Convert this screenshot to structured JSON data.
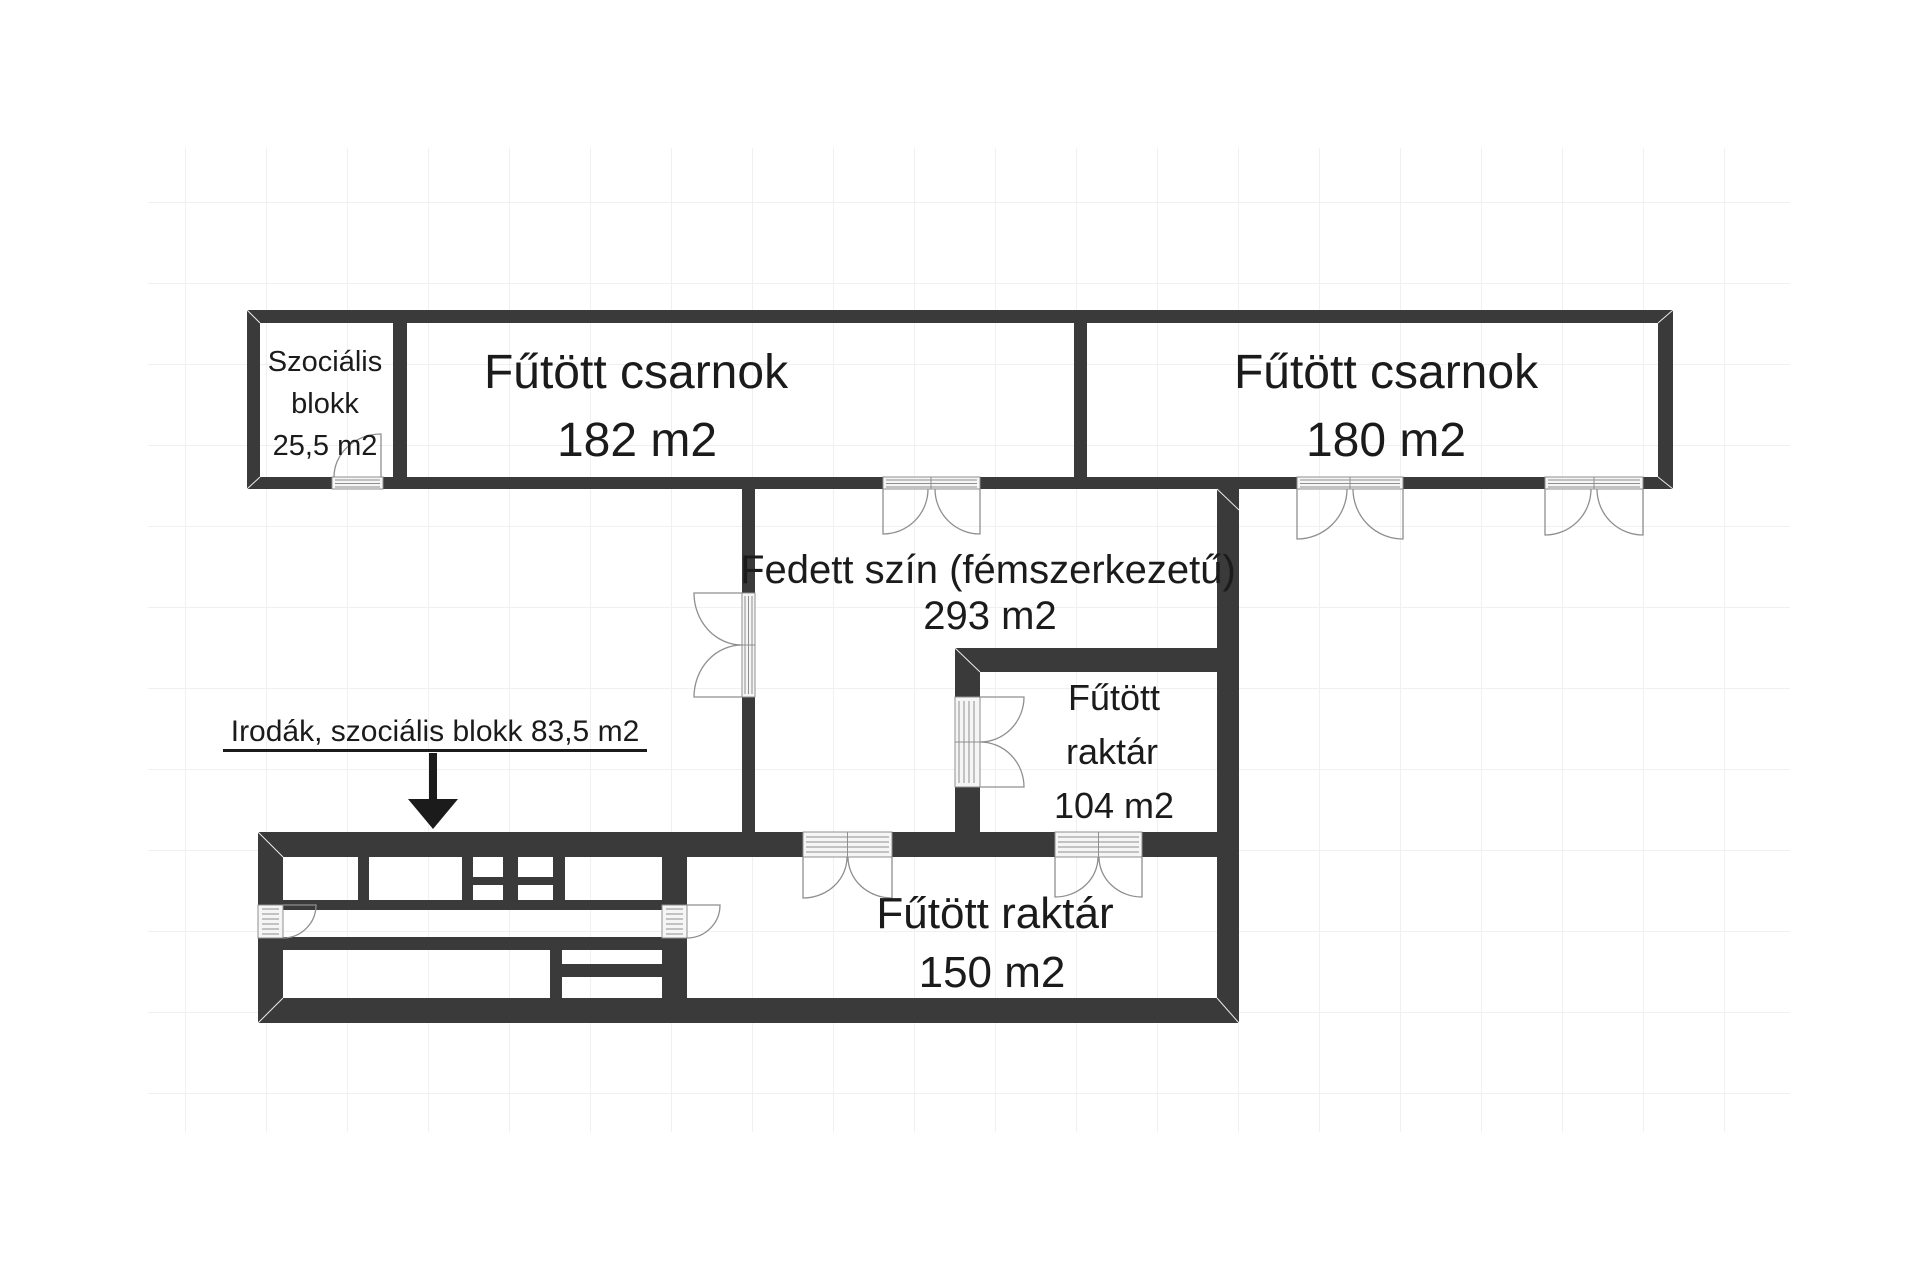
{
  "plan": {
    "rooms": {
      "szocialis_blokk": {
        "lines": [
          "Szociális",
          "blokk",
          "25,5 m2"
        ]
      },
      "csarnok_182": {
        "lines": [
          "Fűtött csarnok",
          "182 m2"
        ]
      },
      "csarnok_180": {
        "lines": [
          "Fűtött csarnok",
          "180 m2"
        ]
      },
      "fedett_szin": {
        "lines": [
          "Fedett szín (fémszerkezetű)",
          "293 m2"
        ]
      },
      "raktar_104": {
        "lines": [
          "Fűtött",
          "raktár",
          "104 m2"
        ]
      },
      "raktar_150": {
        "lines": [
          "Fűtött raktár",
          "150 m2"
        ]
      }
    },
    "annotation": {
      "text": "Irodák, szociális blokk 83,5 m2"
    },
    "colors": {
      "wall": "#3a3a3a",
      "ink": "#1b1b1b",
      "grid": "#f0f0f0",
      "door_fill": "#f5f5f5",
      "door_stroke": "#8f8f8f"
    }
  }
}
